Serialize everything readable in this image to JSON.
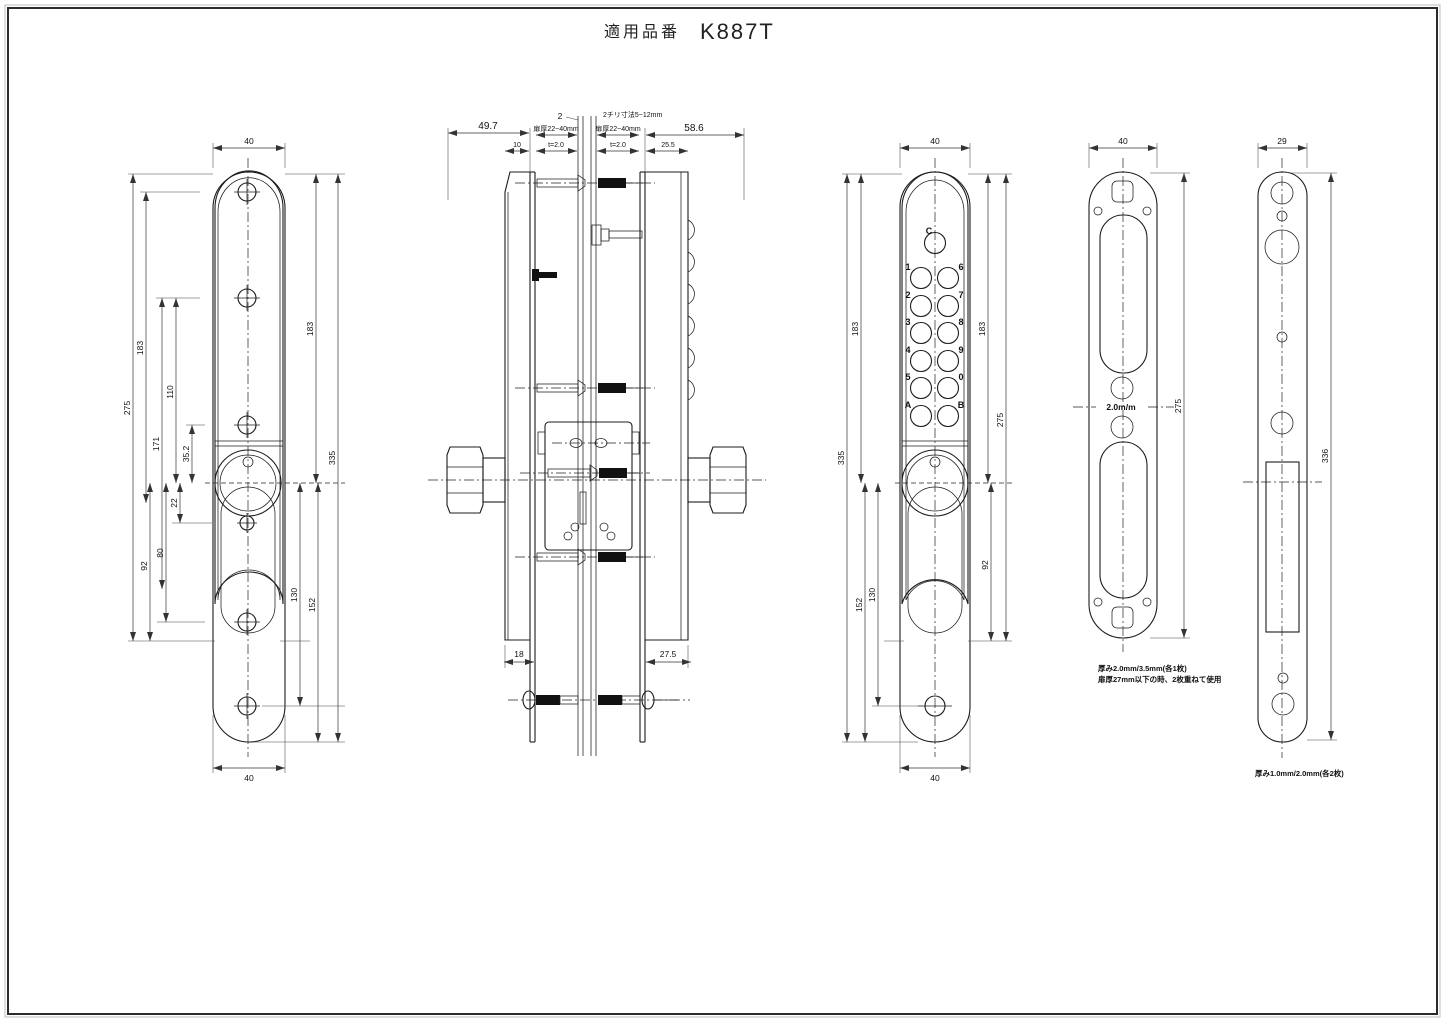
{
  "title": {
    "label": "適用品番",
    "part": "K887T"
  },
  "front": {
    "dim40_top": "40",
    "dim40_bottom": "40",
    "d275": "275",
    "d183l": "183",
    "d171": "171",
    "d110": "110",
    "d35_2": "35.2",
    "d22": "22",
    "d80": "80",
    "d92": "92",
    "d183r": "183",
    "d335": "335",
    "d130": "130",
    "d152": "152"
  },
  "section": {
    "d49_7": "49.7",
    "d58_6": "58.6",
    "d2": "2",
    "clearance": "2チリ寸法5~12mm",
    "doorL": "扉厚22~40mm",
    "doorR": "扉厚22~40mm",
    "tL": "t=2.0",
    "tR": "t=2.0",
    "d10": "10",
    "d25_5": "25.5",
    "d18": "18",
    "d27_5": "27.5"
  },
  "keypad": {
    "dim40_top": "40",
    "dim40_bottom": "40",
    "d335": "335",
    "d183l": "183",
    "d152": "152",
    "d130": "130",
    "d183r": "183",
    "d275": "275",
    "d92": "92",
    "keys": {
      "c": "C",
      "k1": "1",
      "k2": "2",
      "k3": "3",
      "k4": "4",
      "k5": "5",
      "k6": "6",
      "k7": "7",
      "k8": "8",
      "k9": "9",
      "k0": "0",
      "ka": "A",
      "kb": "B"
    }
  },
  "spacer": {
    "d40": "40",
    "d275": "275",
    "thickness": "2.0m/m",
    "note1": "厚み2.0mm/3.5mm(各1枚)",
    "note2": "扉厚27mm以下の時、2枚重ねて使用"
  },
  "strike": {
    "d29": "29",
    "d336": "336",
    "note": "厚み1.0mm/2.0mm(各2枚)"
  },
  "colors": {
    "line": "#1c1c1c",
    "background": "#ffffff"
  }
}
